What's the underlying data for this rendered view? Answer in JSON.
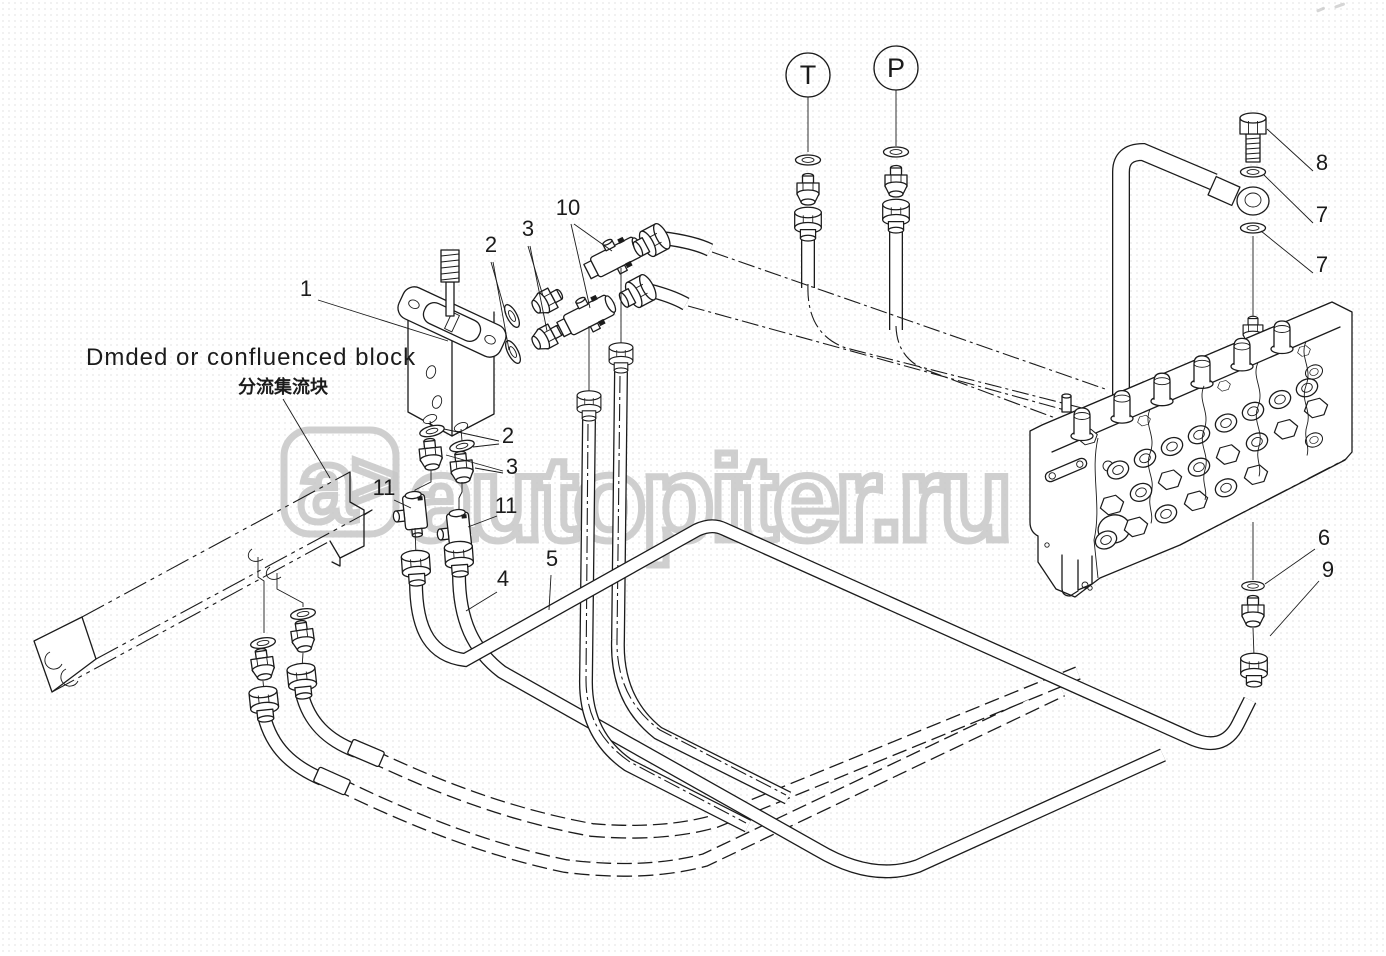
{
  "labels": {
    "title_en": "Dmded or confluenced block",
    "title_zh": "分流集流块"
  },
  "ports": {
    "t": "T",
    "p": "P"
  },
  "watermark": {
    "logo_a": "a",
    "logo_gt": ">",
    "main": "autopiter.ru"
  },
  "colors": {
    "line": "#1b1b1b",
    "watermark": "#c7c7c7",
    "background": "#ffffff"
  },
  "callouts": [
    {
      "n": "1",
      "x": 306,
      "y": 296,
      "lines": [
        [
          318,
          300,
          448,
          341
        ]
      ]
    },
    {
      "n": "2",
      "x": 491,
      "y": 252,
      "lines": [
        [
          491,
          262,
          506,
          314
        ],
        [
          493,
          262,
          509,
          350
        ]
      ]
    },
    {
      "n": "3",
      "x": 528,
      "y": 236,
      "lines": [
        [
          528,
          246,
          543,
          296
        ],
        [
          530,
          246,
          547,
          331
        ]
      ]
    },
    {
      "n": "10",
      "x": 568,
      "y": 215,
      "lines": [
        [
          574,
          224,
          612,
          251
        ],
        [
          571,
          224,
          590,
          308
        ]
      ]
    },
    {
      "n": "2",
      "x": 508,
      "y": 443,
      "lines": [
        [
          499,
          441,
          444,
          429
        ],
        [
          499,
          444,
          473,
          447
        ]
      ]
    },
    {
      "n": "3",
      "x": 512,
      "y": 474,
      "lines": [
        [
          503,
          471,
          446,
          455
        ],
        [
          503,
          473,
          475,
          468
        ]
      ]
    },
    {
      "n": "11",
      "x": 384,
      "y": 495,
      "lines": [
        [
          394,
          500,
          411,
          508
        ]
      ]
    },
    {
      "n": "11",
      "x": 506,
      "y": 513,
      "lines": [
        [
          497,
          516,
          468,
          527
        ]
      ]
    },
    {
      "n": "4",
      "x": 503,
      "y": 586,
      "lines": [
        [
          497,
          592,
          466,
          611
        ]
      ]
    },
    {
      "n": "5",
      "x": 552,
      "y": 566,
      "lines": [
        [
          551,
          575,
          549,
          610
        ]
      ]
    },
    {
      "n": "8",
      "x": 1322,
      "y": 170,
      "lines": [
        [
          1313,
          171,
          1267,
          129
        ]
      ]
    },
    {
      "n": "7",
      "x": 1322,
      "y": 222,
      "lines": [
        [
          1313,
          223,
          1264,
          175
        ]
      ]
    },
    {
      "n": "7",
      "x": 1322,
      "y": 272,
      "lines": [
        [
          1313,
          273,
          1261,
          231
        ]
      ]
    },
    {
      "n": "6",
      "x": 1324,
      "y": 545,
      "lines": [
        [
          1315,
          549,
          1265,
          584
        ]
      ]
    },
    {
      "n": "9",
      "x": 1328,
      "y": 577,
      "lines": [
        [
          1319,
          581,
          1270,
          636
        ]
      ]
    }
  ]
}
